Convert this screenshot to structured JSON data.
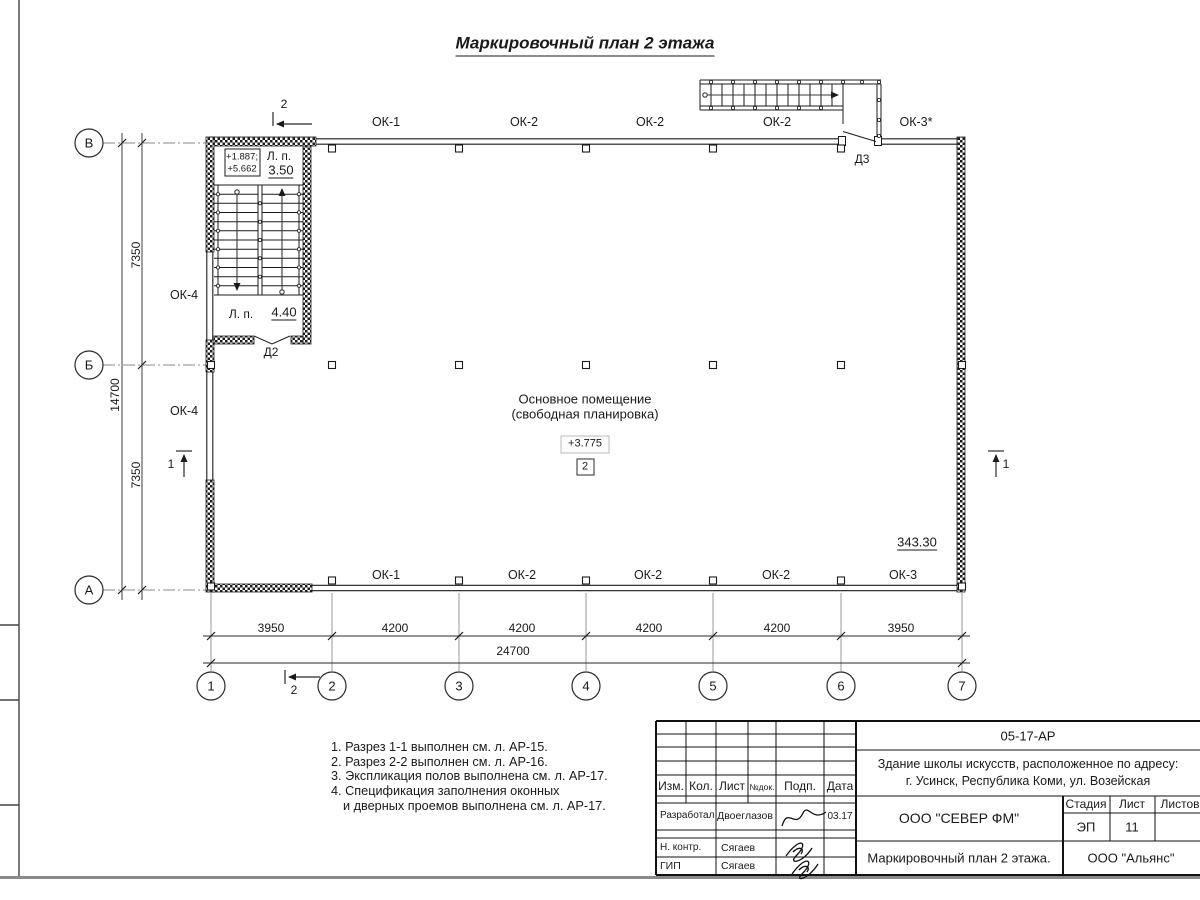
{
  "title": "Маркировочный план 2 этажа",
  "plan": {
    "room": {
      "line1": "Основное помещение",
      "line2": "(свободная планировка)",
      "elevation": "+3.775",
      "zone": "2"
    },
    "elevation_right": "343.30",
    "stair": {
      "elev_line1": "+1.887;",
      "elev_line2": "+5.662",
      "lp_label_top": "Л. п.",
      "lp_value_top": "3.50",
      "lp_label_bottom": "Л. п.",
      "lp_value_bottom": "4.40",
      "door2": "Д2",
      "door3": "Д3"
    },
    "windows_top": [
      "ОК-1",
      "ОК-2",
      "ОК-2",
      "ОК-2",
      "ОК-3*"
    ],
    "windows_bottom": [
      "ОК-1",
      "ОК-2",
      "ОК-2",
      "ОК-2",
      "ОК-3"
    ],
    "windows_left": [
      "ОК-4",
      "ОК-4"
    ],
    "axes_letters": [
      "В",
      "Б",
      "А"
    ],
    "axes_numbers": [
      "1",
      "2",
      "3",
      "4",
      "5",
      "6",
      "7"
    ],
    "dims_bottom": [
      "3950",
      "4200",
      "4200",
      "4200",
      "4200",
      "3950"
    ],
    "dim_total_bottom": "24700",
    "dims_left": [
      "7350",
      "7350"
    ],
    "dim_total_left": "14700",
    "section_1": "1",
    "section_2": "2"
  },
  "notes": {
    "items": [
      "1. Разрез 1-1 выполнен см. л. АР-15.",
      "2. Разрез 2-2 выполнен см. л. АР-16.",
      "3. Экспликация полов выполнена см. л. АР-17.",
      "4. Спецификация заполнения оконных",
      "и дверных проемов выполнена см. л. АР-17."
    ]
  },
  "titleblock": {
    "doc_number": "05-17-АР",
    "project_line1": "Здание школы искусств, расположенное по адресу:",
    "project_line2": "г. Усинск, Республика Коми, ул. Возейская",
    "col_izm": "Изм.",
    "col_kol": "Кол.",
    "col_list": "Лист",
    "col_ndok": "№док.",
    "col_podp": "Подп.",
    "col_data": "Дата",
    "rows": [
      {
        "role": "Разработал",
        "name": "Двоеглазов",
        "date": "03.17"
      },
      {
        "role": "Н. контр.",
        "name": "Сягаев",
        "date": ""
      },
      {
        "role": "ГИП",
        "name": "Сягаев",
        "date": ""
      }
    ],
    "org1": "ООО \"СЕВЕР ФМ\"",
    "stage_label": "Стадия",
    "sheet_label": "Лист",
    "sheets_label": "Листов",
    "stage_value": "ЭП",
    "sheet_value": "11",
    "drawing_name": "Маркировочный план 2 этажа.",
    "org2": "ООО \"Альянс\""
  }
}
